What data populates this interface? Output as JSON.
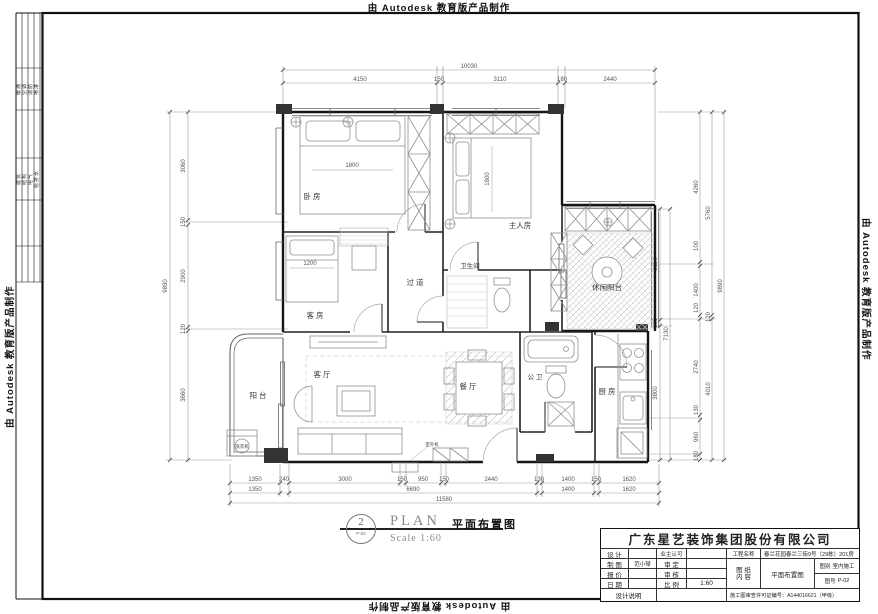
{
  "edge": {
    "autodesk": "由 Autodesk 教育版产品制作"
  },
  "signature_strip": {
    "group1": [
      "暖通",
      "空调",
      "消防",
      "喷淋"
    ],
    "group2": [
      "建筑",
      "结构",
      "电气",
      "给排水"
    ]
  },
  "plan_title": {
    "number": "2",
    "sheet": "P-02",
    "name_en": "PLAN",
    "name_cn": "平面布置图",
    "scale": "Scale 1:60"
  },
  "title_block": {
    "company": "广东星艺装饰集团股份有限公司",
    "left_rows": [
      {
        "label": "设 计",
        "value": "",
        "label2": "业主认可",
        "value2": ""
      },
      {
        "label": "制 图",
        "value": "范小琴",
        "label2": "审 定",
        "value2": ""
      },
      {
        "label": "报 价",
        "value": "",
        "label2": "审 核",
        "value2": ""
      },
      {
        "label": "日 期",
        "value": "",
        "label2": "比 例",
        "value2": "1:60"
      }
    ],
    "project_label": "工程名称",
    "project_value": "春兰花园春兰三街9号（29栋）201房",
    "sheet_label_1": "图 纸",
    "sheet_label_2": "内 容",
    "sheet_value": "平面布置图",
    "type_label": "图别",
    "type_value": "室内施工",
    "no_label": "图号",
    "no_value": "P-02",
    "notes_label": "设计说明",
    "permit": "施工图审查许可证编号：A144016621（甲级）"
  },
  "rooms": {
    "bedroom": "卧 房",
    "master": "主人房",
    "guest": "客 房",
    "corridor": "过 道",
    "bath": "卫生间",
    "leisure": "休闲阳台",
    "living": "客 厅",
    "dining": "餐 厅",
    "public_bath": "公 卫",
    "kitchen": "厨 房",
    "balcony": "阳 台",
    "washer": "洗衣机",
    "outdoor_unit": "室外机"
  },
  "furniture_dims": {
    "bed_main": "1800",
    "bed_master": "1800",
    "bed_guest": "1200"
  },
  "dimensions": {
    "top": {
      "total": "10030",
      "segments": [
        "4150",
        "150",
        "3110",
        "180",
        "2440"
      ]
    },
    "left": {
      "total": "9890",
      "segments": [
        "3060",
        "150",
        "2900",
        "120",
        "3660"
      ]
    },
    "right": {
      "inner": [
        "3150",
        "180",
        "3800"
      ],
      "inner_total": "7130",
      "middle": [
        "4260",
        "100",
        "1400",
        "120",
        "2740",
        "130",
        "960",
        "180"
      ],
      "outer": [
        "5760",
        "120",
        "4010"
      ],
      "total": "9890"
    },
    "bottom": {
      "row1": [
        "1350",
        "240",
        "3000",
        "150",
        "950",
        "150",
        "2440",
        "130",
        "1400",
        "150",
        "1620"
      ],
      "row2": [
        "1350",
        "6690",
        "1400",
        "1620"
      ],
      "total": "11580"
    }
  }
}
